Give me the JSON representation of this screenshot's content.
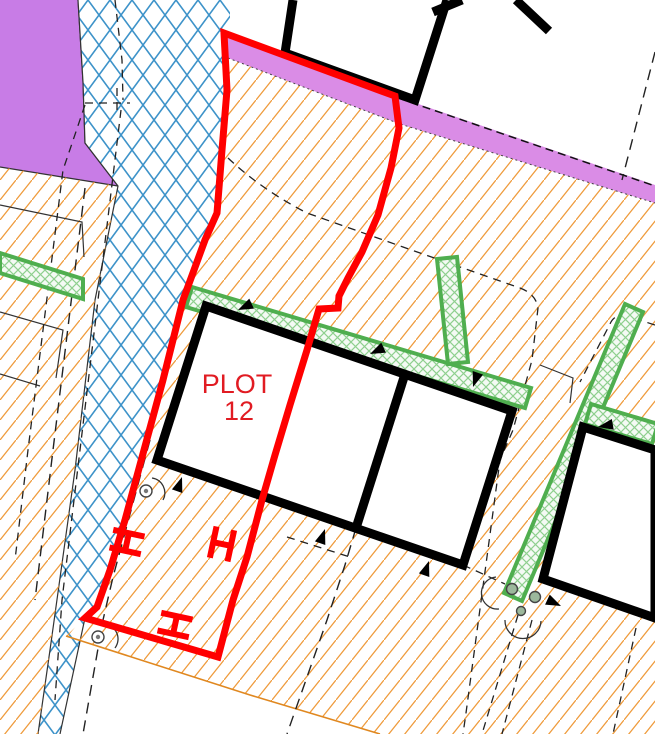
{
  "title": "Site plan extract - Plot 12",
  "plot": {
    "label_line1": "PLOT",
    "label_line2": "12"
  },
  "colors": {
    "red": "#ff0000",
    "labelRed": "#e11b22",
    "orange": "#ef9b3c",
    "orangeEdge": "#e08820",
    "blue": "#3e93c9",
    "green": "#4fae4f",
    "greenFill": "#8ed08e",
    "greenMarker": "#9cb89c",
    "magenta": "#da8ce6",
    "purple": "#c87ce6",
    "black": "#000000"
  },
  "features": {
    "plot_boundary": "red-plot-boundary",
    "ground": "orange-hatched-ground",
    "path_band": "blue-crosshatched-band",
    "road_strip": "magenta-road-strip",
    "adjacent_area": "purple-area",
    "buildings": "black-building-outlines",
    "landscaping": "green-hatched-strips",
    "gates": "red-gate-symbols",
    "survey_points": "circle-markers-with-arcs",
    "entrances": "black-door-triangles",
    "parcel_lines": "black-dashed-parcel-lines"
  }
}
